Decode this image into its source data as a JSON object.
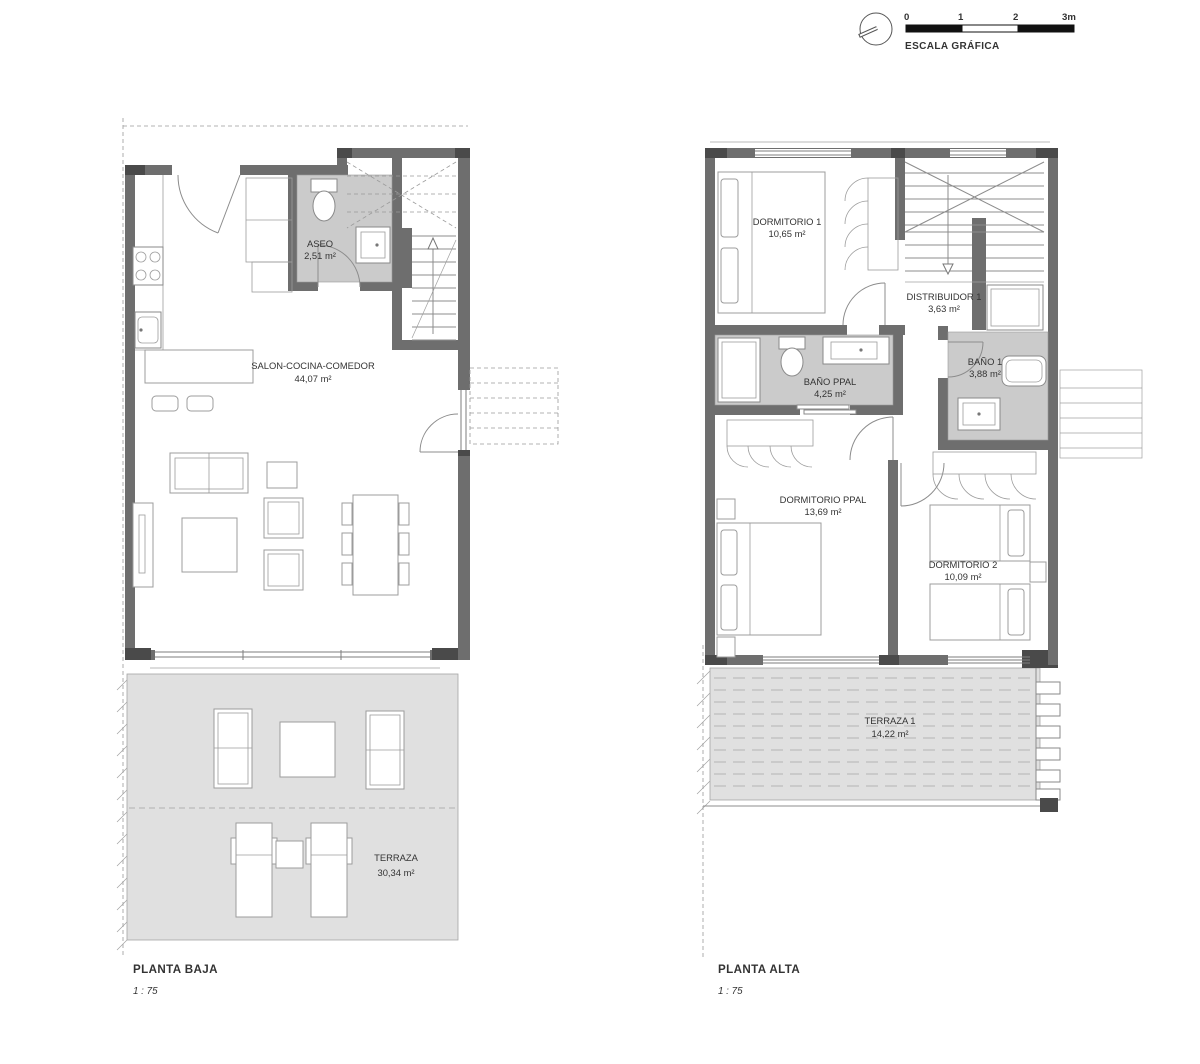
{
  "scale_bar": {
    "ticks": [
      "0",
      "1",
      "2",
      "3m"
    ],
    "caption": "ESCALA GRÁFICA"
  },
  "planta_baja": {
    "title": "PLANTA BAJA",
    "scale_text": "1 : 75",
    "rooms": [
      {
        "id": "aseo",
        "name": "ASEO",
        "area": "2,51 m²"
      },
      {
        "id": "salon-cocina-comedor",
        "name": "SALON-COCINA-COMEDOR",
        "area": "44,07 m²"
      },
      {
        "id": "terraza",
        "name": "TERRAZA",
        "area": "30,34 m²"
      }
    ]
  },
  "planta_alta": {
    "title": "PLANTA ALTA",
    "scale_text": "1 : 75",
    "rooms": [
      {
        "id": "dormitorio-1",
        "name": "DORMITORIO 1",
        "area": "10,65 m²"
      },
      {
        "id": "distribuidor-1",
        "name": "DISTRIBUIDOR 1",
        "area": "3,63 m²"
      },
      {
        "id": "bano-ppal",
        "name": "BAÑO PPAL",
        "area": "4,25 m²"
      },
      {
        "id": "bano-1",
        "name": "BAÑO 1",
        "area": "3,88 m²"
      },
      {
        "id": "dormitorio-ppal",
        "name": "DORMITORIO PPAL",
        "area": "13,69 m²"
      },
      {
        "id": "dormitorio-2",
        "name": "DORMITORIO 2",
        "area": "10,09 m²"
      },
      {
        "id": "terraza-1",
        "name": "TERRAZA 1",
        "area": "14,22 m²"
      }
    ]
  },
  "colors": {
    "wall": "#6e6e6e",
    "column": "#4a4a4a",
    "bath_floor": "#cbcbcb",
    "terrace_floor": "#e0e0e0",
    "text": "#333333"
  }
}
